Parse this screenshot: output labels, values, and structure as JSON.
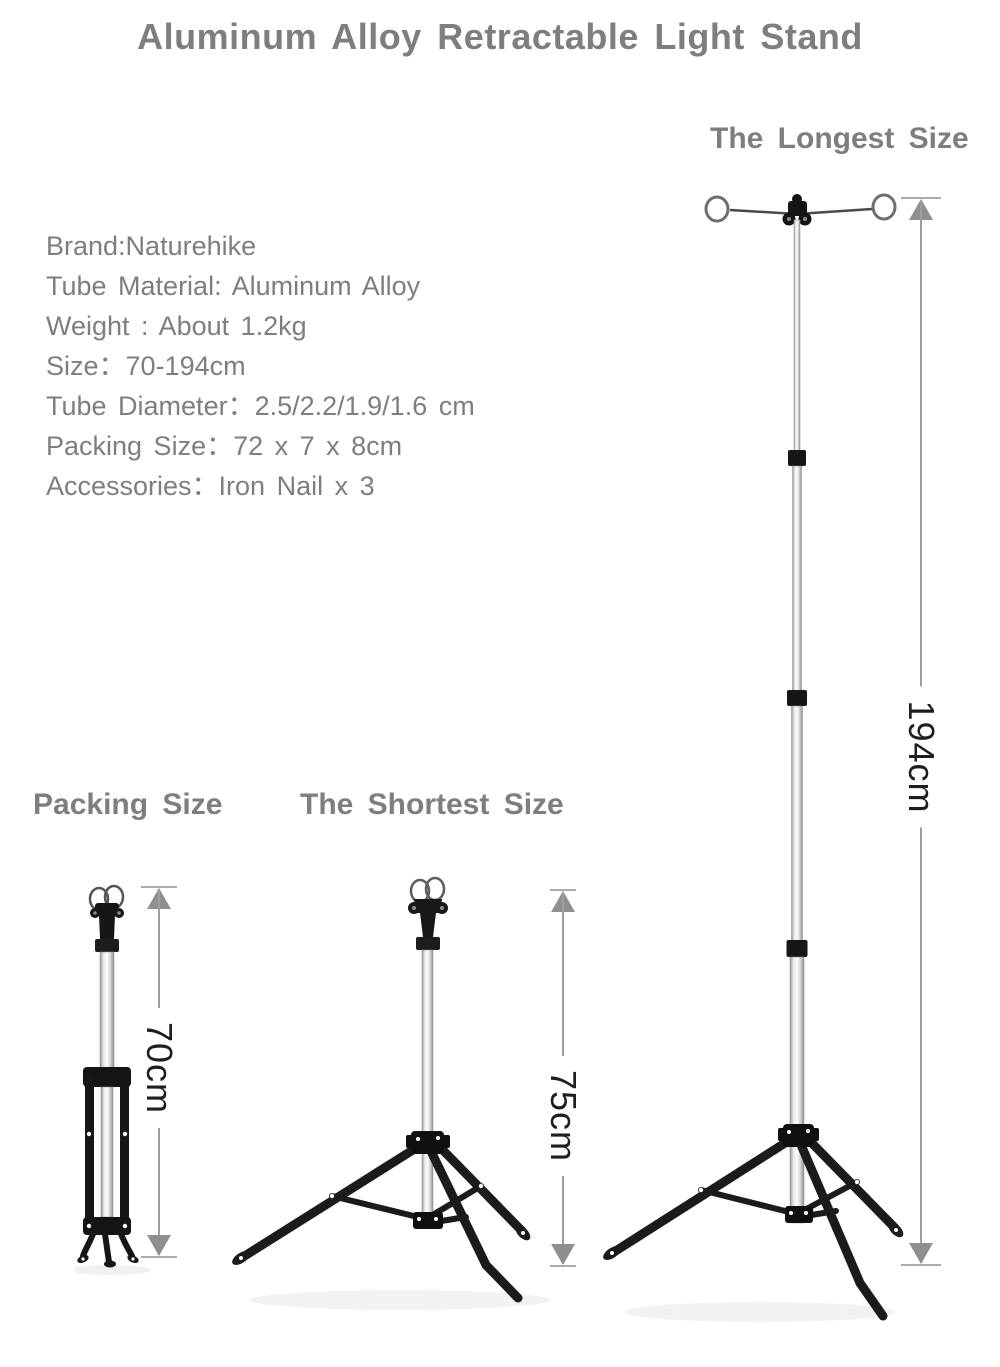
{
  "title": "Aluminum Alloy Retractable Light Stand",
  "specs": {
    "lines": [
      "Brand:Naturehike",
      "Tube Material: Aluminum Alloy",
      "Weight : About 1.2kg",
      "Size：70-194cm",
      "Tube Diameter：2.5/2.2/1.9/1.6 cm",
      "Packing Size：72 x 7 x 8cm",
      "Accessories：Iron Nail x 3"
    ]
  },
  "sections": {
    "longest": {
      "heading": "The Longest Size",
      "dimension": "194cm"
    },
    "packing": {
      "heading": "Packing Size",
      "dimension": "70cm"
    },
    "shortest": {
      "heading": "The Shortest Size",
      "dimension": "75cm"
    }
  },
  "colors": {
    "heading_text": "#7e7e7e",
    "dimension_text": "#1e1e1e",
    "arrow_gray": "#9e9e9e",
    "stand_black": "#1a1a1a",
    "pole_silver": "#d9d9d9",
    "background": "#ffffff"
  }
}
